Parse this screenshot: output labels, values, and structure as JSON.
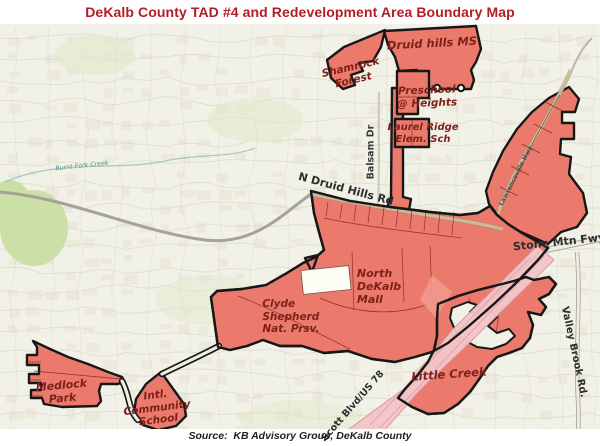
{
  "title": "DeKalb County TAD #4 and Redevelopment Area Boundary Map",
  "source": "Source:  KB Advisory Group, DeKalb County",
  "colors": {
    "title": "#b21d22",
    "tad_fill": "#ec7a6c",
    "freeway_band": "#f4c5c9",
    "boundary": "#171717",
    "area_label": "#7e211b",
    "road_label": "#2e2e2e",
    "background": "#f2f1e7"
  },
  "map": {
    "area_labels": {
      "shamrock_forest": "Shamrock\nForest",
      "druid_hills_ms": "Druid hills MS",
      "preschool_heights": "Preschool\n@ Heights",
      "laurel_ridge": "Laurel Ridge\nElem. Sch",
      "north_dekalb_mall": "North\nDeKalb\nMall",
      "clyde_shepherd": "Clyde\nShepherd\nNat. Prsv.",
      "medlock_park": "Medlock\nPark",
      "intl_community_school": "Intl.\nCommunity\nSchool",
      "little_creek": "Little Creek"
    },
    "road_labels": {
      "n_druid_hills_rd": "N Druid Hills Rd",
      "balsam_dr": "Balsam Dr",
      "lawrenceville_hwy": "Lawrenceville Hwy",
      "stone_mtn_fwy": "Stone Mtn Fwy",
      "scott_blvd_us78": "Scott Blvd/US 78",
      "valley_brook_rd": "Valley Brook Rd."
    },
    "water_labels": {
      "burnt_fork_creek": "Burnt Fork Creek"
    }
  }
}
